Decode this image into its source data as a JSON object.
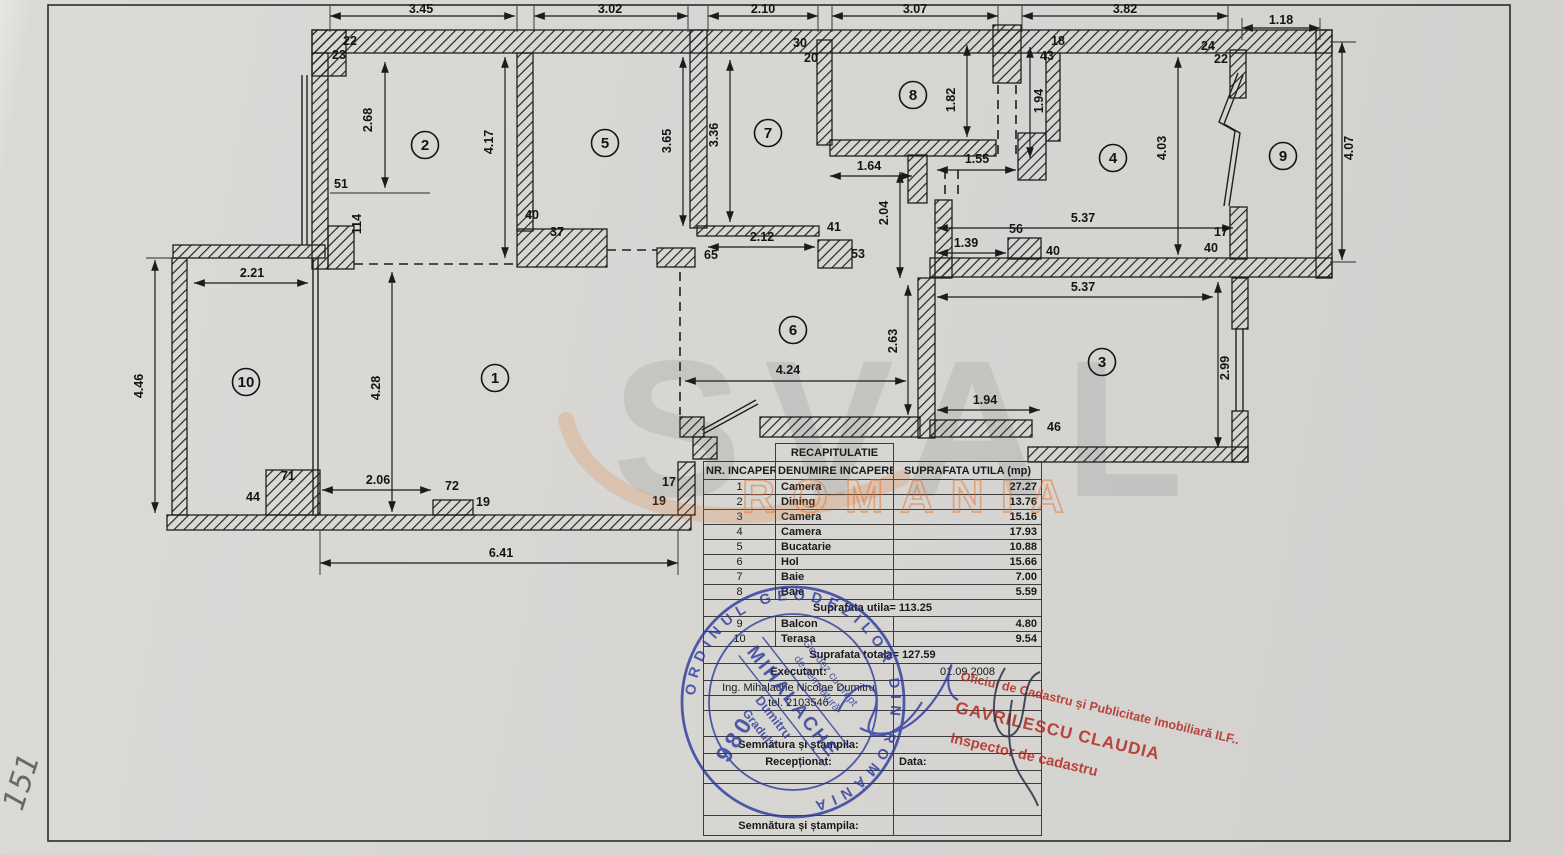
{
  "page": {
    "corner_note": "151"
  },
  "plan": {
    "rooms": [
      {
        "n": "1",
        "x": 495,
        "y": 378
      },
      {
        "n": "2",
        "x": 425,
        "y": 145
      },
      {
        "n": "3",
        "x": 1102,
        "y": 362
      },
      {
        "n": "4",
        "x": 1113,
        "y": 158
      },
      {
        "n": "5",
        "x": 605,
        "y": 143
      },
      {
        "n": "6",
        "x": 793,
        "y": 330
      },
      {
        "n": "7",
        "x": 768,
        "y": 133
      },
      {
        "n": "8",
        "x": 913,
        "y": 95
      },
      {
        "n": "9",
        "x": 1283,
        "y": 156
      },
      {
        "n": "10",
        "x": 246,
        "y": 382
      }
    ],
    "dims": [
      {
        "t": "3.45",
        "x": 421,
        "y": 13
      },
      {
        "t": "3.02",
        "x": 610,
        "y": 13
      },
      {
        "t": "2.10",
        "x": 763,
        "y": 13
      },
      {
        "t": "3.07",
        "x": 915,
        "y": 13
      },
      {
        "t": "3.82",
        "x": 1125,
        "y": 13
      },
      {
        "t": "1.18",
        "x": 1281,
        "y": 24
      },
      {
        "t": "22",
        "x": 350,
        "y": 45
      },
      {
        "t": "23",
        "x": 339,
        "y": 59
      },
      {
        "t": "2.68",
        "x": 372,
        "y": 120,
        "r": 1
      },
      {
        "t": "51",
        "x": 341,
        "y": 188
      },
      {
        "t": "114",
        "x": 361,
        "y": 224,
        "r": 1
      },
      {
        "t": "4.17",
        "x": 493,
        "y": 142,
        "r": 1
      },
      {
        "t": "3.65",
        "x": 671,
        "y": 141,
        "r": 1
      },
      {
        "t": "40",
        "x": 532,
        "y": 219
      },
      {
        "t": "37",
        "x": 557,
        "y": 236
      },
      {
        "t": "65",
        "x": 711,
        "y": 259
      },
      {
        "t": "3.36",
        "x": 718,
        "y": 135,
        "r": 1
      },
      {
        "t": "2.12",
        "x": 762,
        "y": 241
      },
      {
        "t": "41",
        "x": 834,
        "y": 231
      },
      {
        "t": "53",
        "x": 858,
        "y": 258
      },
      {
        "t": "30",
        "x": 800,
        "y": 47
      },
      {
        "t": "20",
        "x": 811,
        "y": 62
      },
      {
        "t": "1.82",
        "x": 955,
        "y": 100,
        "r": 1
      },
      {
        "t": "1.64",
        "x": 869,
        "y": 170
      },
      {
        "t": "2.04",
        "x": 888,
        "y": 213,
        "r": 1
      },
      {
        "t": "1.55",
        "x": 977,
        "y": 163
      },
      {
        "t": "43",
        "x": 1047,
        "y": 60
      },
      {
        "t": "18",
        "x": 1058,
        "y": 45
      },
      {
        "t": "1.94",
        "x": 1043,
        "y": 101,
        "r": 1
      },
      {
        "t": "5.37",
        "x": 1083,
        "y": 222
      },
      {
        "t": "56",
        "x": 1016,
        "y": 233
      },
      {
        "t": "1.39",
        "x": 966,
        "y": 247
      },
      {
        "t": "40",
        "x": 1053,
        "y": 255
      },
      {
        "t": "17",
        "x": 1221,
        "y": 236
      },
      {
        "t": "40",
        "x": 1211,
        "y": 252
      },
      {
        "t": "24",
        "x": 1208,
        "y": 50
      },
      {
        "t": "22",
        "x": 1221,
        "y": 63
      },
      {
        "t": "4.03",
        "x": 1166,
        "y": 148,
        "r": 1
      },
      {
        "t": "4.07",
        "x": 1353,
        "y": 148,
        "r": 1
      },
      {
        "t": "5.37",
        "x": 1083,
        "y": 291
      },
      {
        "t": "2.99",
        "x": 1229,
        "y": 368,
        "r": 1
      },
      {
        "t": "1.94",
        "x": 985,
        "y": 404
      },
      {
        "t": "46",
        "x": 1054,
        "y": 431
      },
      {
        "t": "2.63",
        "x": 897,
        "y": 341,
        "r": 1
      },
      {
        "t": "4.24",
        "x": 788,
        "y": 374
      },
      {
        "t": "4.28",
        "x": 380,
        "y": 388,
        "r": 1
      },
      {
        "t": "2.21",
        "x": 252,
        "y": 277
      },
      {
        "t": "4.46",
        "x": 143,
        "y": 386,
        "r": 1
      },
      {
        "t": "71",
        "x": 288,
        "y": 480
      },
      {
        "t": "44",
        "x": 253,
        "y": 501
      },
      {
        "t": "2.06",
        "x": 378,
        "y": 484
      },
      {
        "t": "72",
        "x": 452,
        "y": 490
      },
      {
        "t": "19",
        "x": 483,
        "y": 506
      },
      {
        "t": "17",
        "x": 669,
        "y": 486
      },
      {
        "t": "19",
        "x": 659,
        "y": 505
      },
      {
        "t": "6.41",
        "x": 501,
        "y": 557
      }
    ]
  },
  "watermark": {
    "brand": "SVAL",
    "country": "ROMANIA"
  },
  "table": {
    "title": "RECAPITULATIE",
    "col1": "NR. INCAPERE",
    "col2": "DENUMIRE INCAPERE",
    "col3": "SUPRAFATA UTILA (mp)",
    "rows": [
      {
        "nr": "1",
        "name": "Camera",
        "area": "27.27"
      },
      {
        "nr": "2",
        "name": "Dining",
        "area": "13.76"
      },
      {
        "nr": "3",
        "name": "Camera",
        "area": "15.16"
      },
      {
        "nr": "4",
        "name": "Camera",
        "area": "17.93"
      },
      {
        "nr": "5",
        "name": "Bucatarie",
        "area": "10.88"
      },
      {
        "nr": "6",
        "name": "Hol",
        "area": "15.66"
      },
      {
        "nr": "7",
        "name": "Baie",
        "area": "7.00"
      },
      {
        "nr": "8",
        "name": "Baie",
        "area": "5.59"
      }
    ],
    "subtotal": "Suprafata utila= 113.25",
    "rows2": [
      {
        "nr": "9",
        "name": "Balcon",
        "area": "4.80"
      },
      {
        "nr": "10",
        "name": "Terasa",
        "area": "9.54"
      }
    ],
    "total": "Suprafata totala= 127.59",
    "executant_label": "Executant:",
    "date": "01.09.2008",
    "engineer": "Ing. Mihalache Nicolae Dumitru",
    "phone": "tel. 2103546",
    "signature_label": "Semnătura și ștampila:",
    "received_label": "Recepționat:",
    "date_label": "Data:",
    "signature_label2": "Semnătura și ștampila:"
  },
  "stamps": {
    "blue": {
      "ring": "ORDINUL GEODEZILOR DIN ROMÂNIA",
      "number": "980",
      "line1": "Geodez cu drept",
      "line2": "de semnătură",
      "name": "MIHALACHE",
      "first": "Dumitru",
      "grade": "Gradul I"
    },
    "red": {
      "line1": "Oficiul de Cadastru și Publicitate Imobiliară ILF..",
      "line2": "GAVRILESCU CLAUDIA",
      "line3": "Inspector de cadastru"
    }
  }
}
